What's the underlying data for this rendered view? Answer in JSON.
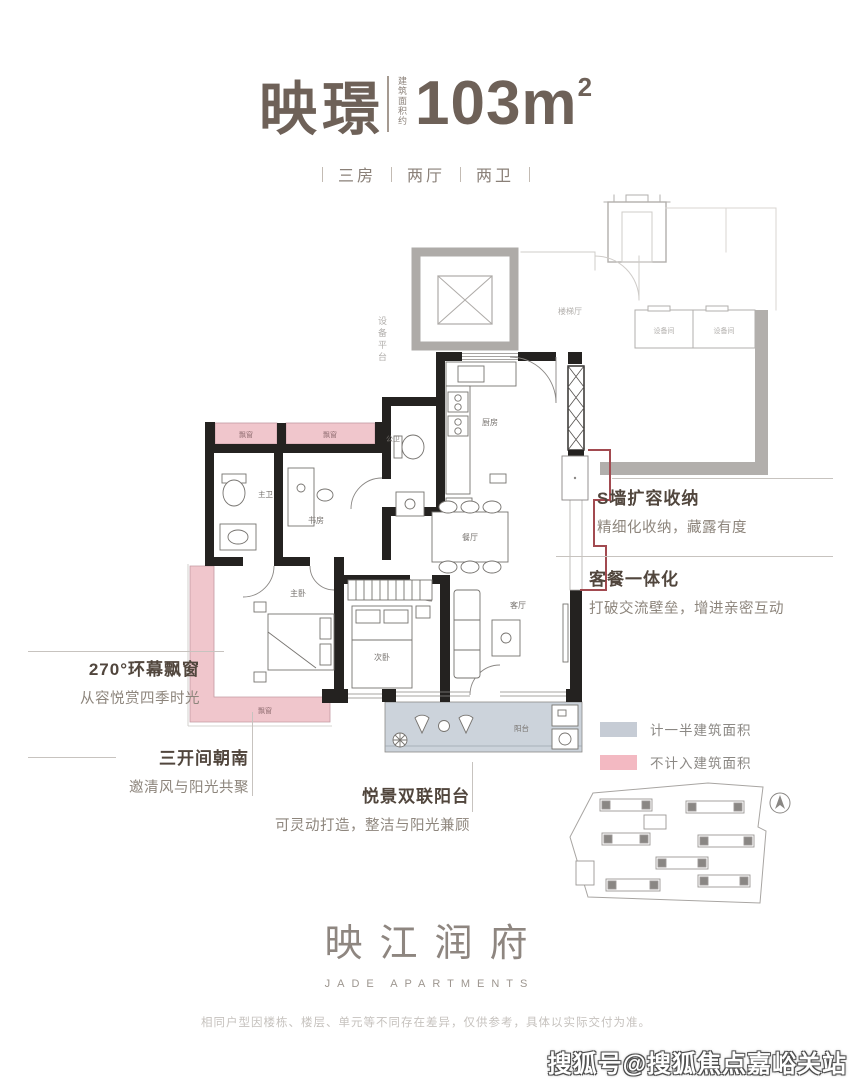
{
  "header": {
    "name": "映璟",
    "area_note": "建筑面积约",
    "area_value": "103m",
    "area_sup": "2",
    "tags": [
      "三房",
      "两厅",
      "两卫"
    ]
  },
  "plan": {
    "stair_hall": "楼梯厅",
    "equipment_platform": "设备平台",
    "equipment_rooms": [
      "设备间",
      "设备间"
    ],
    "bay_window_label": "飘窗",
    "rooms": {
      "master_bath": "主卫",
      "study": "书房",
      "public_bath": "公卫",
      "kitchen": "厨房",
      "dining": "餐厅",
      "master_bedroom": "主卧",
      "second_bedroom": "次卧",
      "living": "客厅",
      "balcony": "阳台"
    }
  },
  "annotations": {
    "s_wall": {
      "title": "S墙扩容收纳",
      "desc": "精细化收纳，藏露有度"
    },
    "dining_living": {
      "title": "客餐一体化",
      "desc": "打破交流壁垒，增进亲密互动"
    },
    "bay_window": {
      "title": "270°环幕飘窗",
      "desc": "从容悦赏四季时光"
    },
    "south_facing": {
      "title": "三开间朝南",
      "desc": "邀清风与阳光共聚"
    },
    "balcony": {
      "title": "悦景双联阳台",
      "desc": "可灵动打造，整洁与阳光兼顾"
    }
  },
  "legend": [
    {
      "label": "计一半建筑面积",
      "color": "#c6ccd5"
    },
    {
      "label": "不计入建筑面积",
      "color": "#f3b9c2"
    }
  ],
  "logo": {
    "name": "映江润府",
    "sub": "JADE APARTMENTS"
  },
  "footer": {
    "disclaimer": "相同户型因楼栋、楼层、单元等不同存在差异，仅供参考，具体以实际交付为准。"
  },
  "watermark": "搜狐号@搜狐焦点嘉峪关站"
}
